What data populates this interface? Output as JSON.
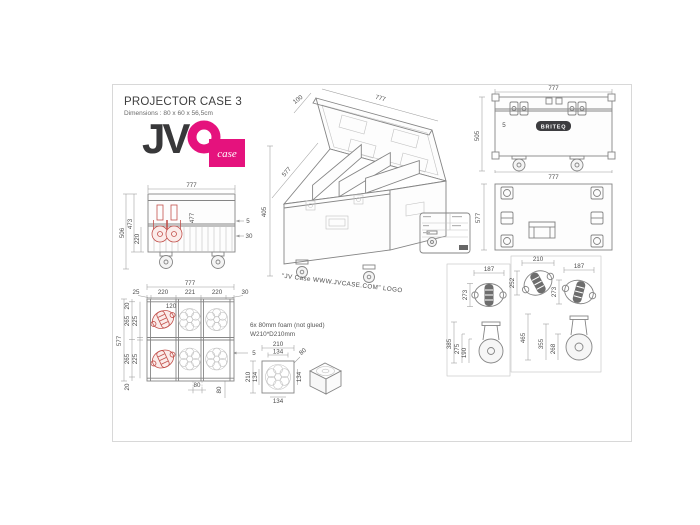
{
  "colors": {
    "accent_pink": "#e5127d",
    "drawing_red": "#c2504b",
    "line_gray": "#8a8a8a",
    "text_gray": "#4c4c4c"
  },
  "header": {
    "title": "PROJECTOR CASE 3",
    "subtitle": "Dimensions : 80 x 60 x 56,5cm"
  },
  "logo": {
    "jv": "JV",
    "case": "case"
  },
  "front_view": {
    "width_top": "777",
    "height_outer": "506",
    "height_inner": "473",
    "height_lower": "220",
    "height_mid": "477",
    "lid_lip": "5",
    "rail": "30"
  },
  "perspective_view": {
    "lid_depth": "100",
    "width": "777",
    "depth": "577",
    "height": "405",
    "caption": "\"JV Case WWW.JVCASE.COM\" LOGO"
  },
  "back_view": {
    "width_top": "777",
    "width_bottom": "777",
    "height": "505",
    "lid_lip": "5",
    "brand": "BRITEQ"
  },
  "top_view": {
    "depth": "577"
  },
  "foam_layout": {
    "width_total": "777",
    "depth_total": "577",
    "columns": [
      "25",
      "220",
      "221",
      "220",
      "30"
    ],
    "rows": [
      "20",
      "265",
      "225",
      "265",
      "225",
      "20"
    ],
    "caster_width": "120",
    "wall_gap": "5",
    "offset_a": "80",
    "offset_b": "80",
    "note_line1": "6x 80mm foam (not glued)",
    "note_line2": "W210*D210mm"
  },
  "foam_detail": {
    "width": "210",
    "width_inner": "134",
    "depth": "210",
    "depth_inner": "134",
    "side_inner": "134",
    "bottom_inner": "134",
    "thickness": "80"
  },
  "caster_detail_small": {
    "width": "187",
    "depth": "273",
    "height_total": "385",
    "height_mid": "275",
    "height_wheel": "190"
  },
  "caster_detail_large": {
    "width_a": "210",
    "depth_a": "252",
    "width_b": "187",
    "depth_b": "273",
    "height_total": "465",
    "height_mid": "355",
    "height_wheel": "268"
  }
}
